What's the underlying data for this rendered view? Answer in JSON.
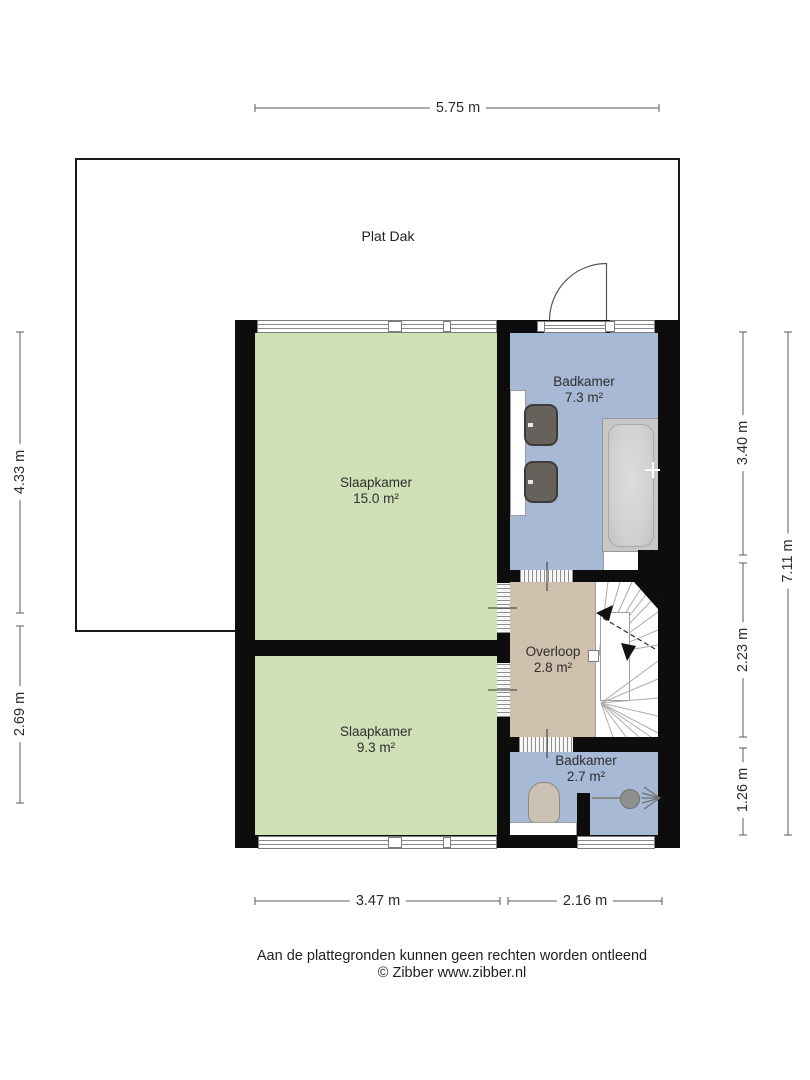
{
  "plan": {
    "outdoor": {
      "label": "Plat Dak"
    },
    "rooms": [
      {
        "name": "Slaapkamer",
        "area": "15.0 m²",
        "color": "#cfe0b6"
      },
      {
        "name": "Slaapkamer",
        "area": "9.3 m²",
        "color": "#cfe0b6"
      },
      {
        "name": "Badkamer",
        "area": "7.3 m²",
        "color": "#a7b9d4"
      },
      {
        "name": "Overloop",
        "area": "2.8 m²",
        "color": "#cec0ad"
      },
      {
        "name": "Badkamer",
        "area": "2.7 m²",
        "color": "#a7b9d4"
      }
    ],
    "wall_color": "#0d0d0d",
    "stair_color": "#ffffff"
  },
  "dimensions": {
    "top": "5.75 m",
    "left_upper": "4.33 m",
    "left_lower": "2.69 m",
    "right_badkamer": "3.40 m",
    "right_overloop": "2.23 m",
    "right_badkamer_klein": "1.26 m",
    "right_total": "7.11 m",
    "bottom_left": "3.47 m",
    "bottom_right": "2.16 m"
  },
  "footer": {
    "disclaimer": "Aan de plattegronden kunnen geen rechten worden ontleend",
    "credit": "© Zibber www.zibber.nl"
  }
}
